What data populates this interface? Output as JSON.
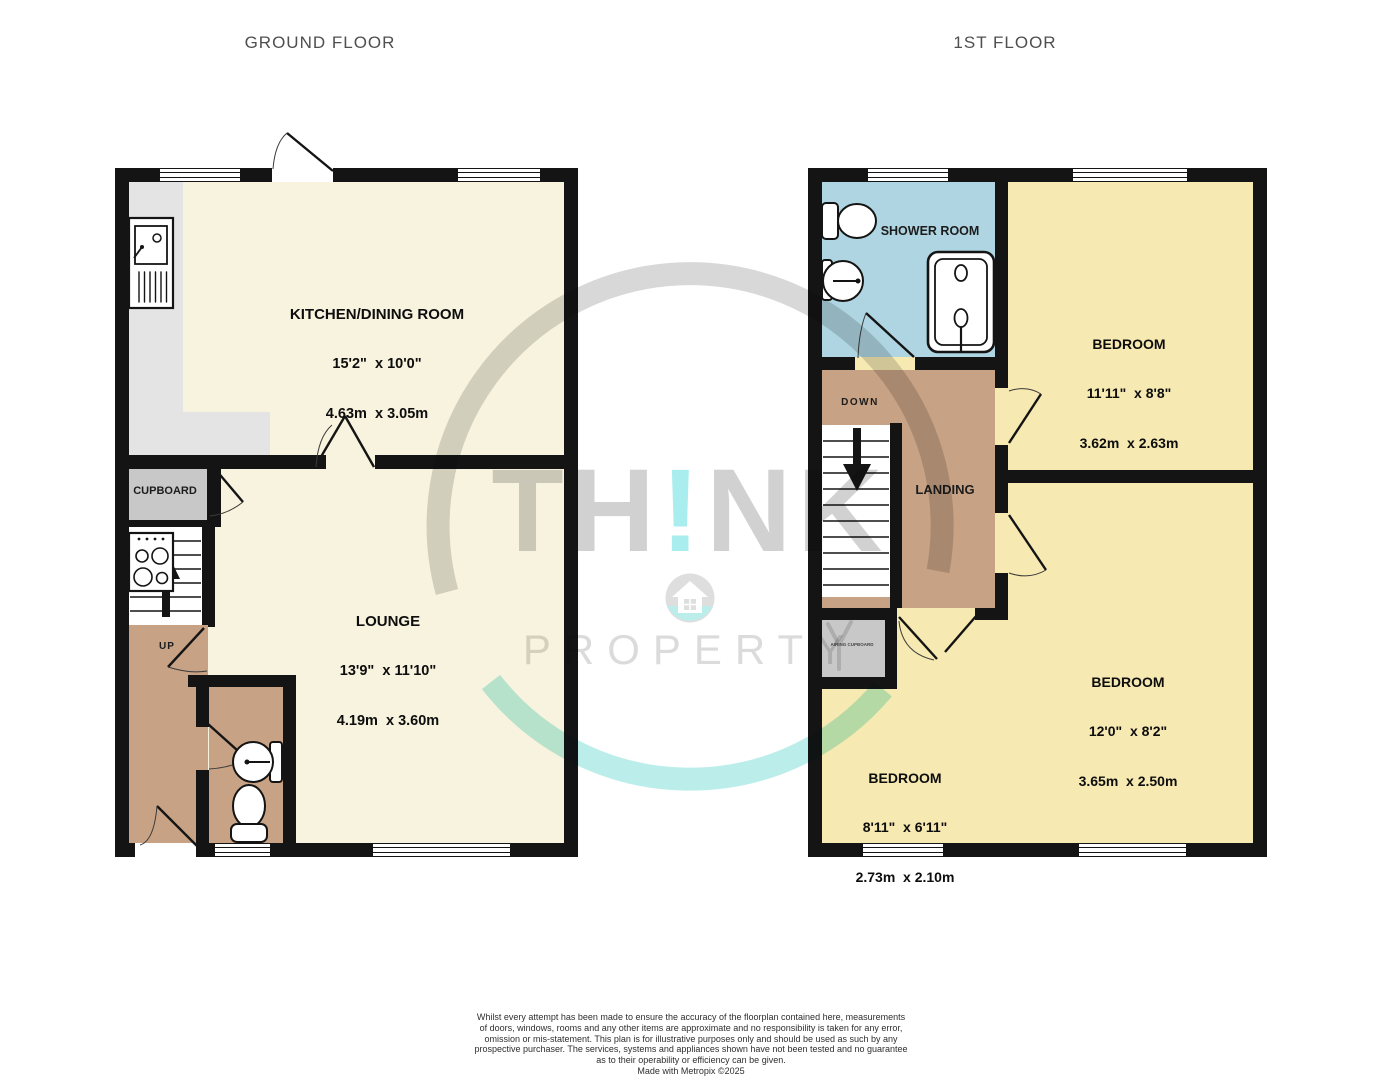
{
  "titles": {
    "ground": "GROUND FLOOR",
    "first": "1ST FLOOR"
  },
  "ground_floor": {
    "kitchen": {
      "name": "KITCHEN/DINING ROOM",
      "imperial": "15'2\"  x 10'0\"",
      "metric": "4.63m  x 3.05m"
    },
    "lounge": {
      "name": "LOUNGE",
      "imperial": "13'9\"  x 11'10\"",
      "metric": "4.19m  x 3.60m"
    },
    "cupboard": {
      "name": "CUPBOARD"
    },
    "stairs": {
      "label": "UP"
    }
  },
  "first_floor": {
    "shower_room": {
      "name": "SHOWER ROOM"
    },
    "landing": {
      "name": "LANDING"
    },
    "stairs": {
      "label": "DOWN"
    },
    "airing_cupboard": {
      "name": "AIRING CUPBOARD"
    },
    "bedroom1": {
      "name": "BEDROOM",
      "imperial": "11'11\"  x 8'8\"",
      "metric": "3.62m  x 2.63m"
    },
    "bedroom2": {
      "name": "BEDROOM",
      "imperial": "12'0\"  x 8'2\"",
      "metric": "3.65m  x 2.50m"
    },
    "bedroom3": {
      "name": "BEDROOM",
      "imperial": "8'11\"  x 6'11\"",
      "metric": "2.73m  x 2.10m"
    }
  },
  "watermark": {
    "brand_part1": "TH",
    "brand_accent": "!",
    "brand_part2": "NK",
    "brand_word2": "PROPERTY"
  },
  "disclaimer": {
    "lines": [
      "Whilst every attempt has been made to ensure the accuracy of the floorplan contained here, measurements",
      "of doors, windows, rooms and any other items are approximate and no responsibility is taken for any error,",
      "omission or mis-statement. This plan is for illustrative purposes only and should be used as such by any",
      "prospective purchaser. The services, systems and appliances shown have not been tested and no guarantee",
      "as to their operability or efficiency can be given.",
      "Made with Metropix ©2025"
    ]
  },
  "colors": {
    "wall": "#141414",
    "cream": "#F8F3DE",
    "yellow": "#F6E9B2",
    "tan": "#C7A284",
    "blue": "#AED5E1",
    "counter": "#E4E4E4",
    "cupboard": "#C8C8C8",
    "accent_teal": "#6FDFDF",
    "watermark_gray": "#ABABAB",
    "title_gray": "#4F4F4F",
    "text": "#0D0D0D"
  }
}
